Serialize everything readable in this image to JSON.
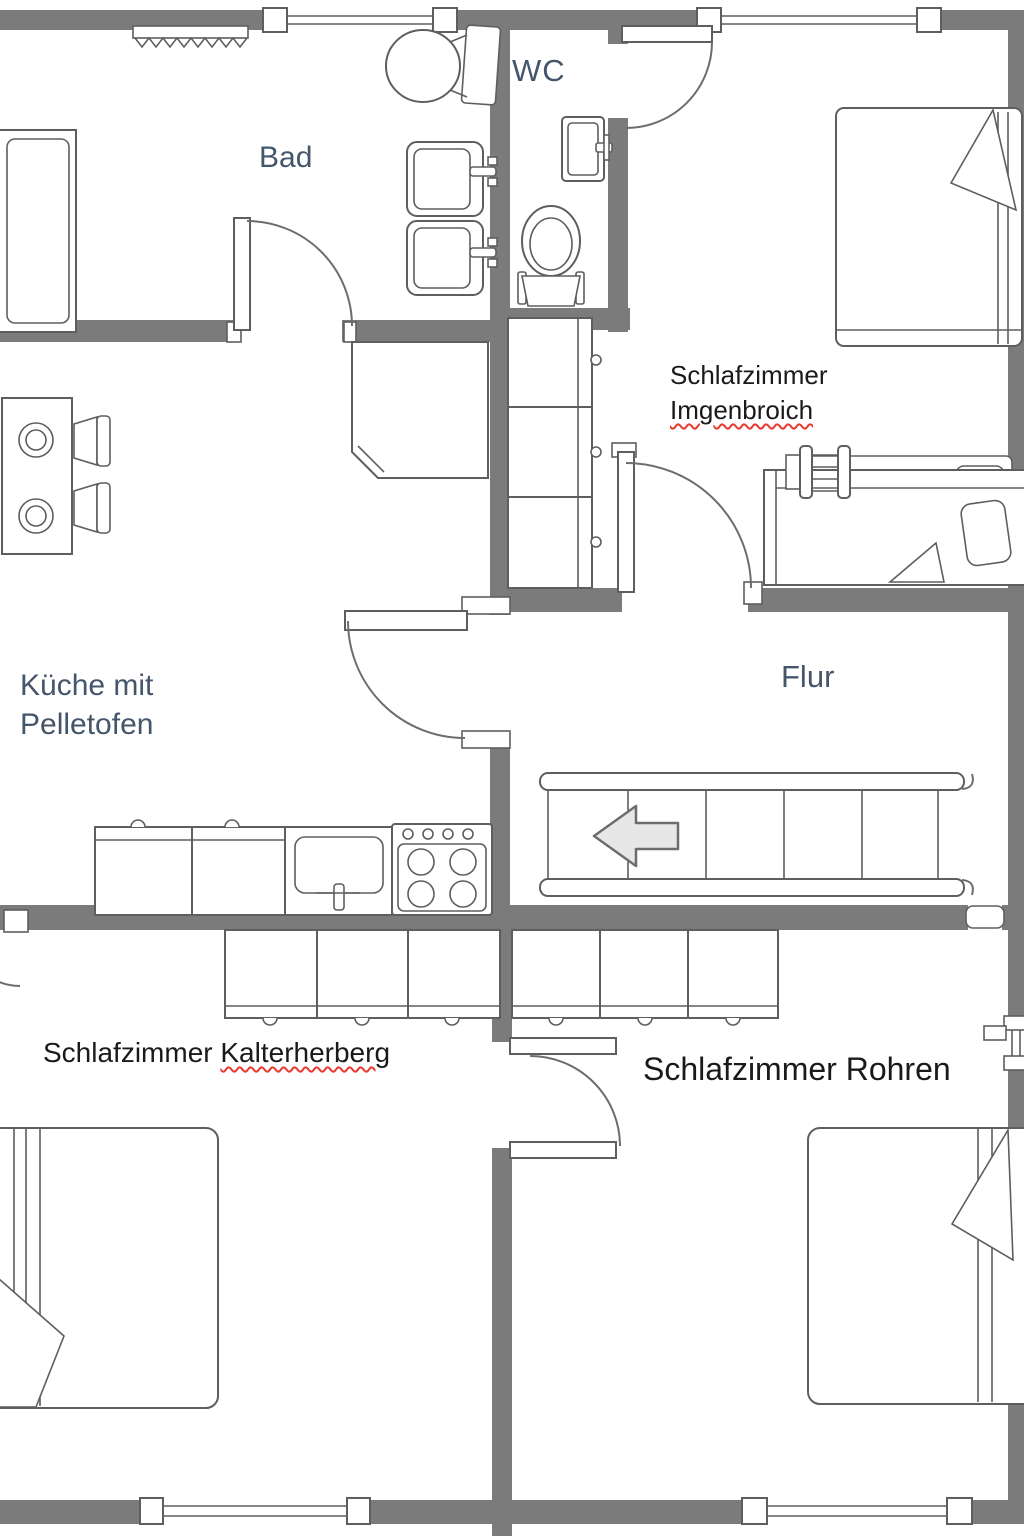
{
  "floorplan": {
    "rooms": {
      "bad": {
        "label": "Bad"
      },
      "wc": {
        "label": "WC"
      },
      "kueche": {
        "line1": "Küche mit",
        "line2": "Pelletofen"
      },
      "flur": {
        "label": "Flur"
      },
      "imgenbroich": {
        "line1": "Schlafzimmer",
        "line2": "Imgenbroich",
        "spellcheck_underline": true
      },
      "kalterherberg": {
        "prefix": "Schlafzimmer ",
        "name": "Kalterherberg",
        "spellcheck_underline": true
      },
      "rohren": {
        "label": "Schlafzimmer Rohren",
        "spellcheck_underline": false
      }
    },
    "furniture": {
      "bad": [
        "radiator",
        "bathtub",
        "toilet",
        "washbasin",
        "washbasin",
        "door"
      ],
      "wc": [
        "hand-basin",
        "toilet",
        "door"
      ],
      "kueche": [
        "dining-table",
        "chair",
        "chair",
        "pellet-stove",
        "tall-cabinet",
        "counter-cabinet",
        "counter-cabinet",
        "kitchen-sink",
        "stove-4-burners",
        "door"
      ],
      "flur": [
        "staircase-with-left-arrow"
      ],
      "imgenbroich": [
        "double-bed",
        "single-bed",
        "radiator",
        "door"
      ],
      "kalterherberg": [
        "wardrobe-3-sections",
        "double-bed",
        "door"
      ],
      "rohren": [
        "wardrobe-3-sections",
        "double-bed",
        "door"
      ]
    },
    "stairs": {
      "direction_arrow": "left",
      "treads": 5
    },
    "colors": {
      "wall": "#7b7b7b",
      "outline": "#5e5e5e",
      "room_label": "#44566b",
      "annotation_label": "#1a1a1a",
      "spellcheck_underline": "#e8392f",
      "arrow_fill": "#e7e7e7"
    }
  }
}
